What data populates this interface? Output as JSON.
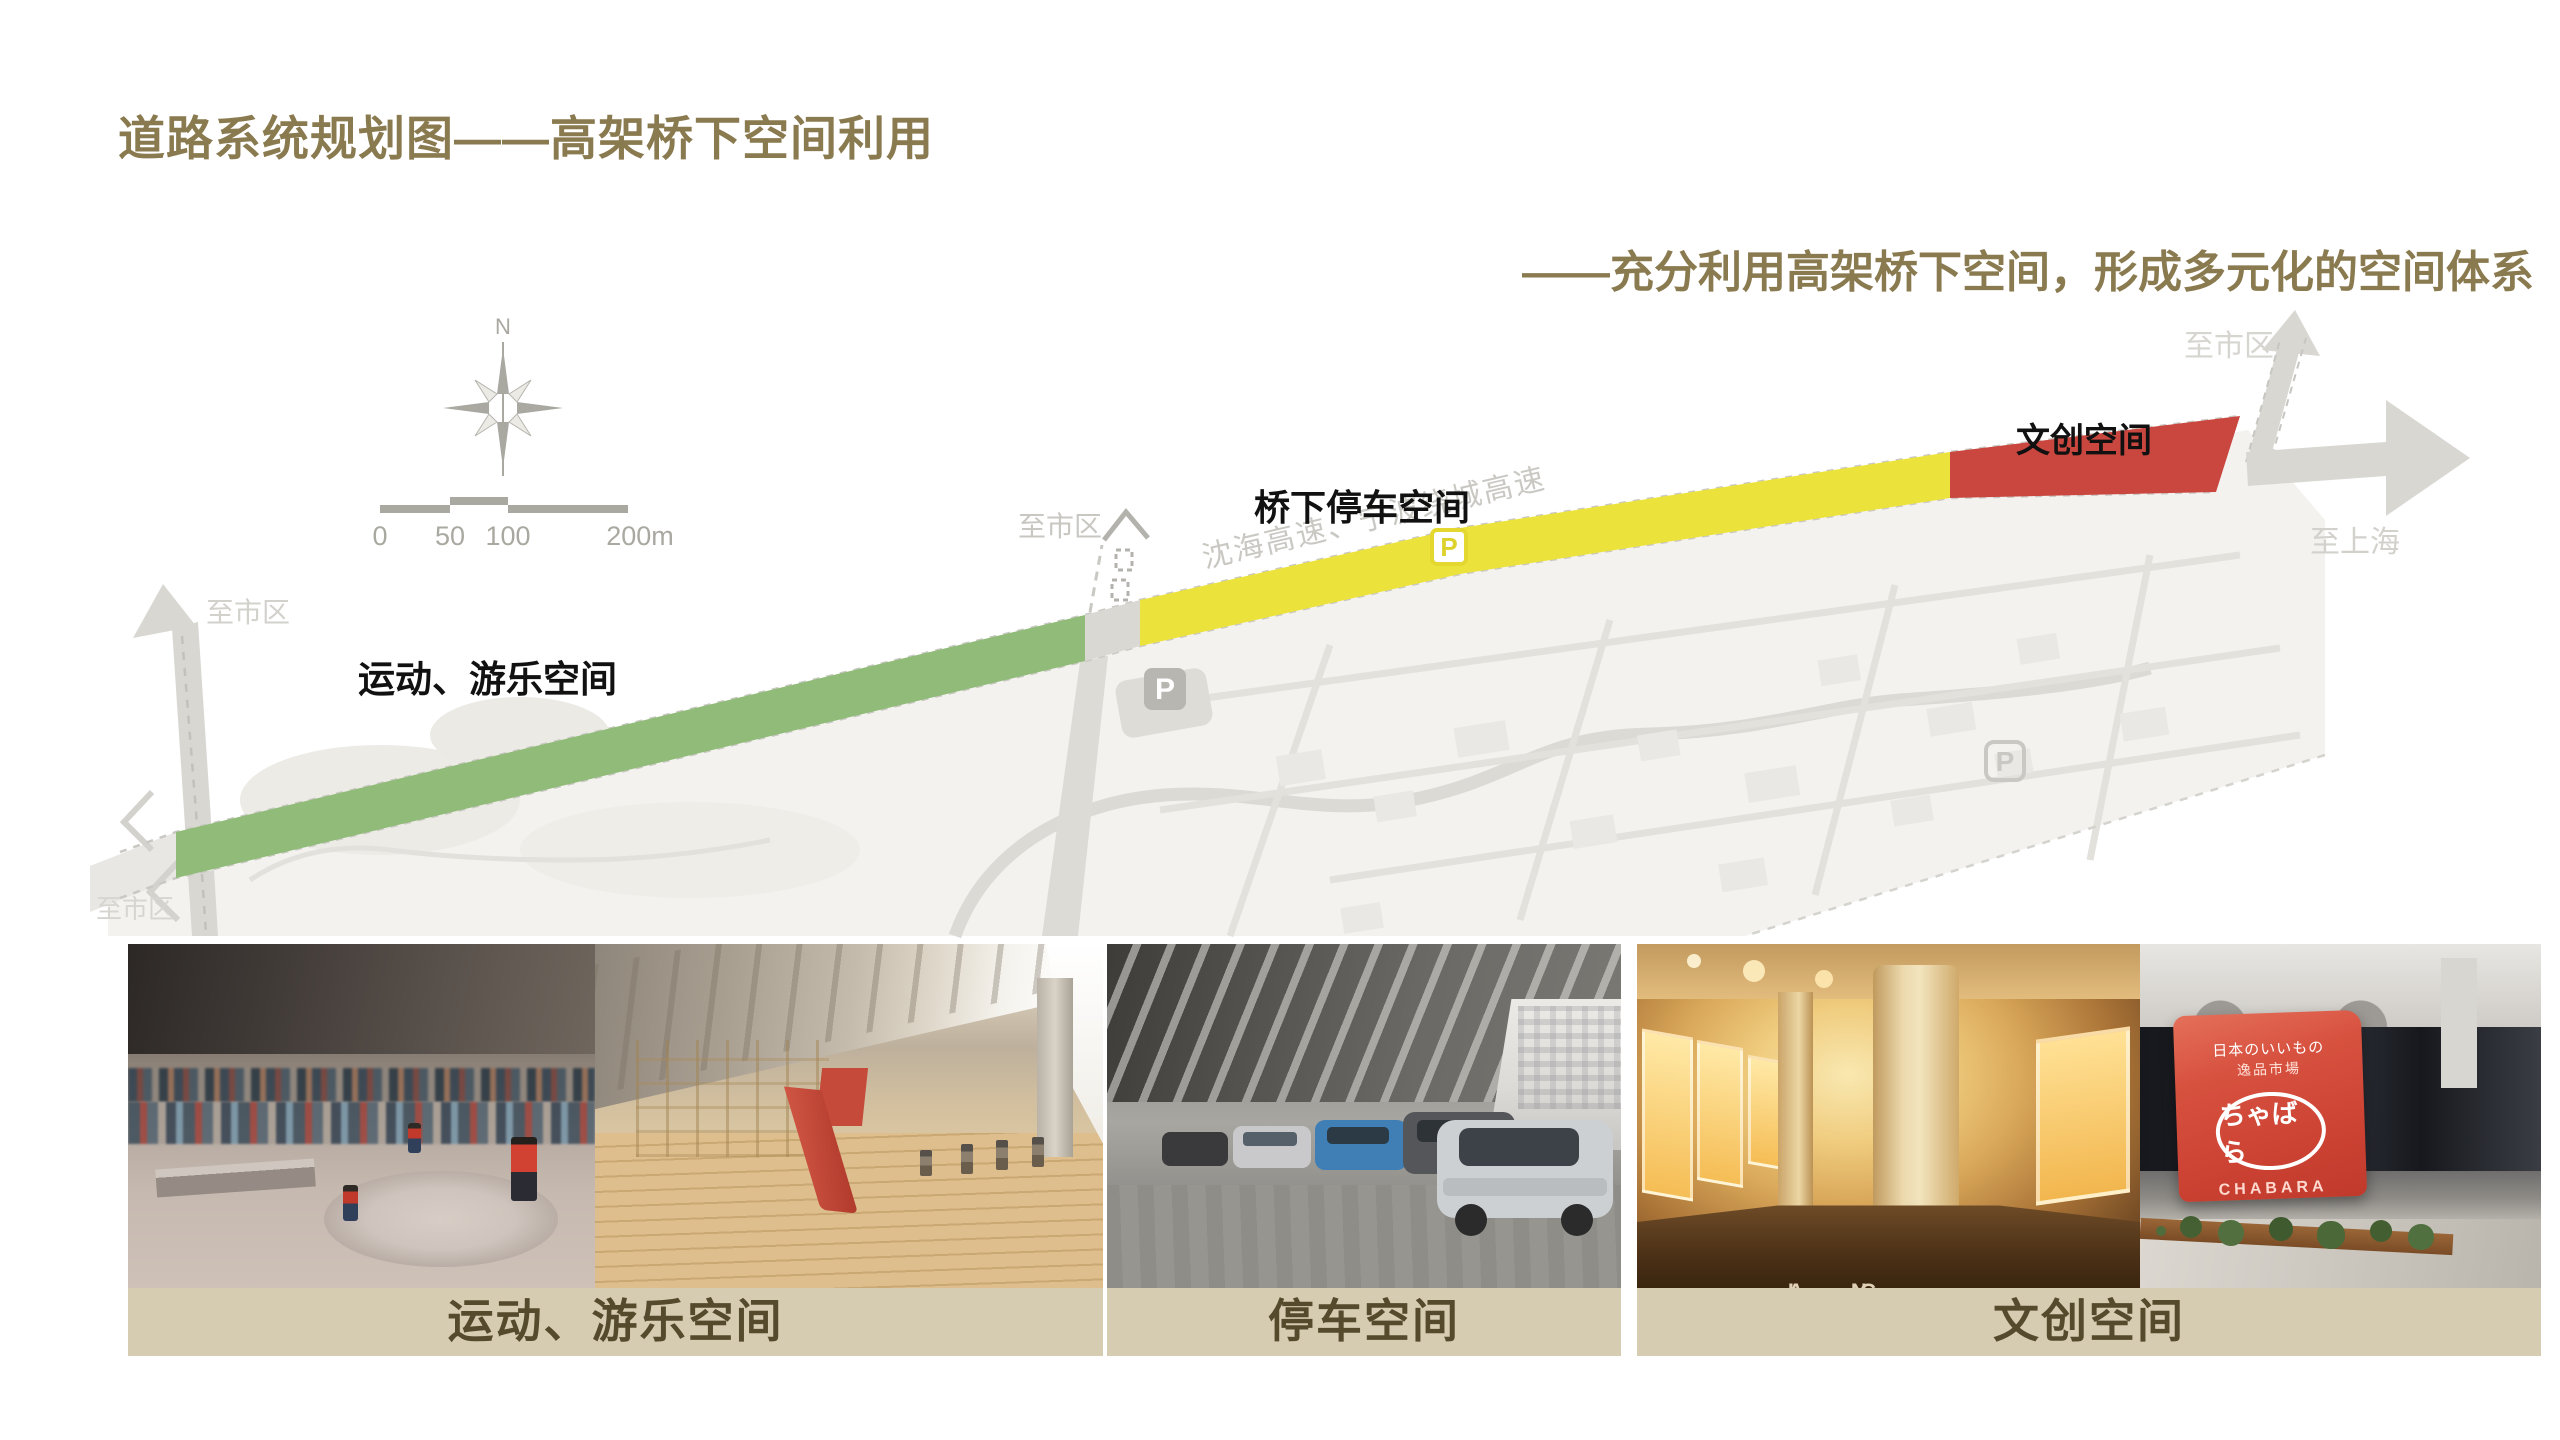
{
  "header": {
    "title": "道路系统规划图——高架桥下空间利用",
    "subtitle": "——充分利用高架桥下空间，形成多元化的空间体系"
  },
  "map": {
    "north_label": "N",
    "scale_ticks": [
      "0",
      "50",
      "100",
      "200m"
    ],
    "segment_labels": {
      "sport": "运动、游乐空间",
      "parking": "桥下停车空间",
      "cultural": "文创空间"
    },
    "highway_name": "沈海高速、宁波绕城高速",
    "directions": {
      "left": "至市区",
      "bottom_left": "至市区",
      "middle": "至市区",
      "top_right": "至市区",
      "right": "至上海"
    },
    "parking_badge": "P"
  },
  "panels": [
    {
      "caption": "运动、游乐空间"
    },
    {
      "caption": "停车空间"
    },
    {
      "caption": "文创空间"
    }
  ],
  "photo_details": {
    "corridor_marks": [
      "A ·· G",
      "I ·· N"
    ],
    "store_sign": {
      "line1": "日本のいいもの",
      "line2": "逸品市場",
      "logo": "ちゃばら",
      "brand": "CHABARA"
    }
  },
  "colors": {
    "accent": "#8a7a4f",
    "sport_green": "#90bb78",
    "parking_yellow": "#ece23c",
    "cultural_red": "#c9473f",
    "caption_bg": "#d5ccb2",
    "caption_text": "#564a2c"
  }
}
